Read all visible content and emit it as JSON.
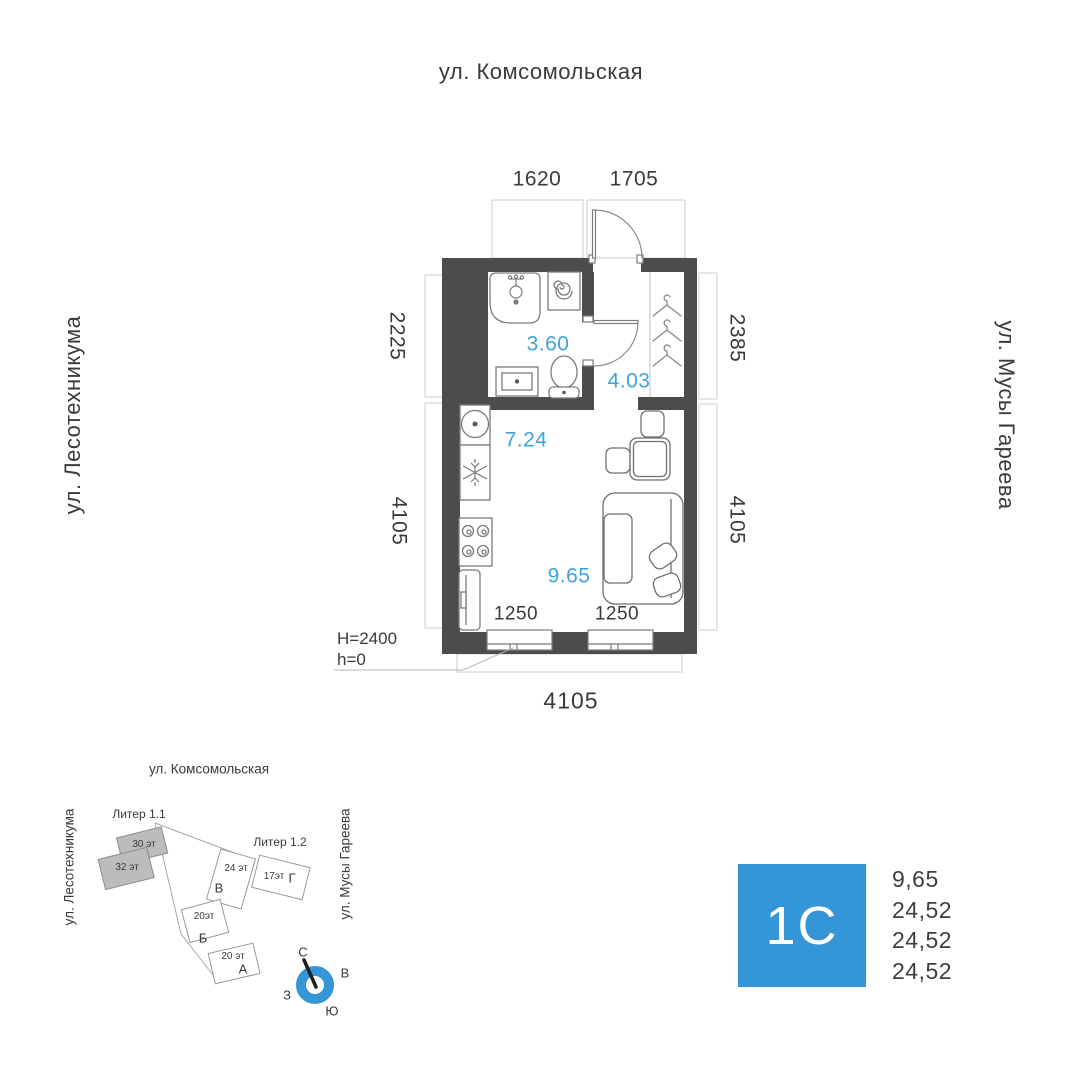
{
  "colors": {
    "wall": "#4c4c4e",
    "fixture_line": "#7b7b7b",
    "dim_box_line": "#cccccc",
    "area_blue": "#3fa2dc",
    "brand_blue": "#3496d6",
    "text": "#3a3a3a",
    "building_gray": "#bcbcbc"
  },
  "plan": {
    "street_top": "ул. Комсомольская",
    "street_left": "ул. Лесотехникума",
    "street_right": "ул. Мусы Гареева",
    "dims": {
      "top1": "1620",
      "top2": "1705",
      "left1": "2225",
      "left2": "4105",
      "right1": "2385",
      "right2": "4105",
      "bottom": "4105",
      "window1": "1250",
      "window2": "1250"
    },
    "areas": {
      "bathroom": "3.60",
      "hallway": "4.03",
      "kitchen": "7.24",
      "living": "9.65"
    },
    "notes": {
      "ceiling": "H=2400",
      "floor_level": "h=0"
    }
  },
  "sitemap": {
    "street_top": "ул. Комсомольская",
    "street_left": "ул. Лесотехникума",
    "street_right": "ул. Мусы Гареева",
    "liter1": "Литер 1.1",
    "liter2": "Литер 1.2",
    "buildings": [
      {
        "floors": "30 эт",
        "letter": ""
      },
      {
        "floors": "32 эт",
        "letter": ""
      },
      {
        "floors": "24 эт",
        "letter": "В"
      },
      {
        "floors": "17эт",
        "letter": "Г"
      },
      {
        "floors": "20эт",
        "letter": "Б"
      },
      {
        "floors": "20 эт",
        "letter": "А"
      }
    ],
    "compass": {
      "n": "С",
      "e": "В",
      "w": "З",
      "s": "Ю"
    }
  },
  "info": {
    "unit_type": "1С",
    "values": [
      "9,65",
      "24,52",
      "24,52",
      "24,52"
    ]
  }
}
